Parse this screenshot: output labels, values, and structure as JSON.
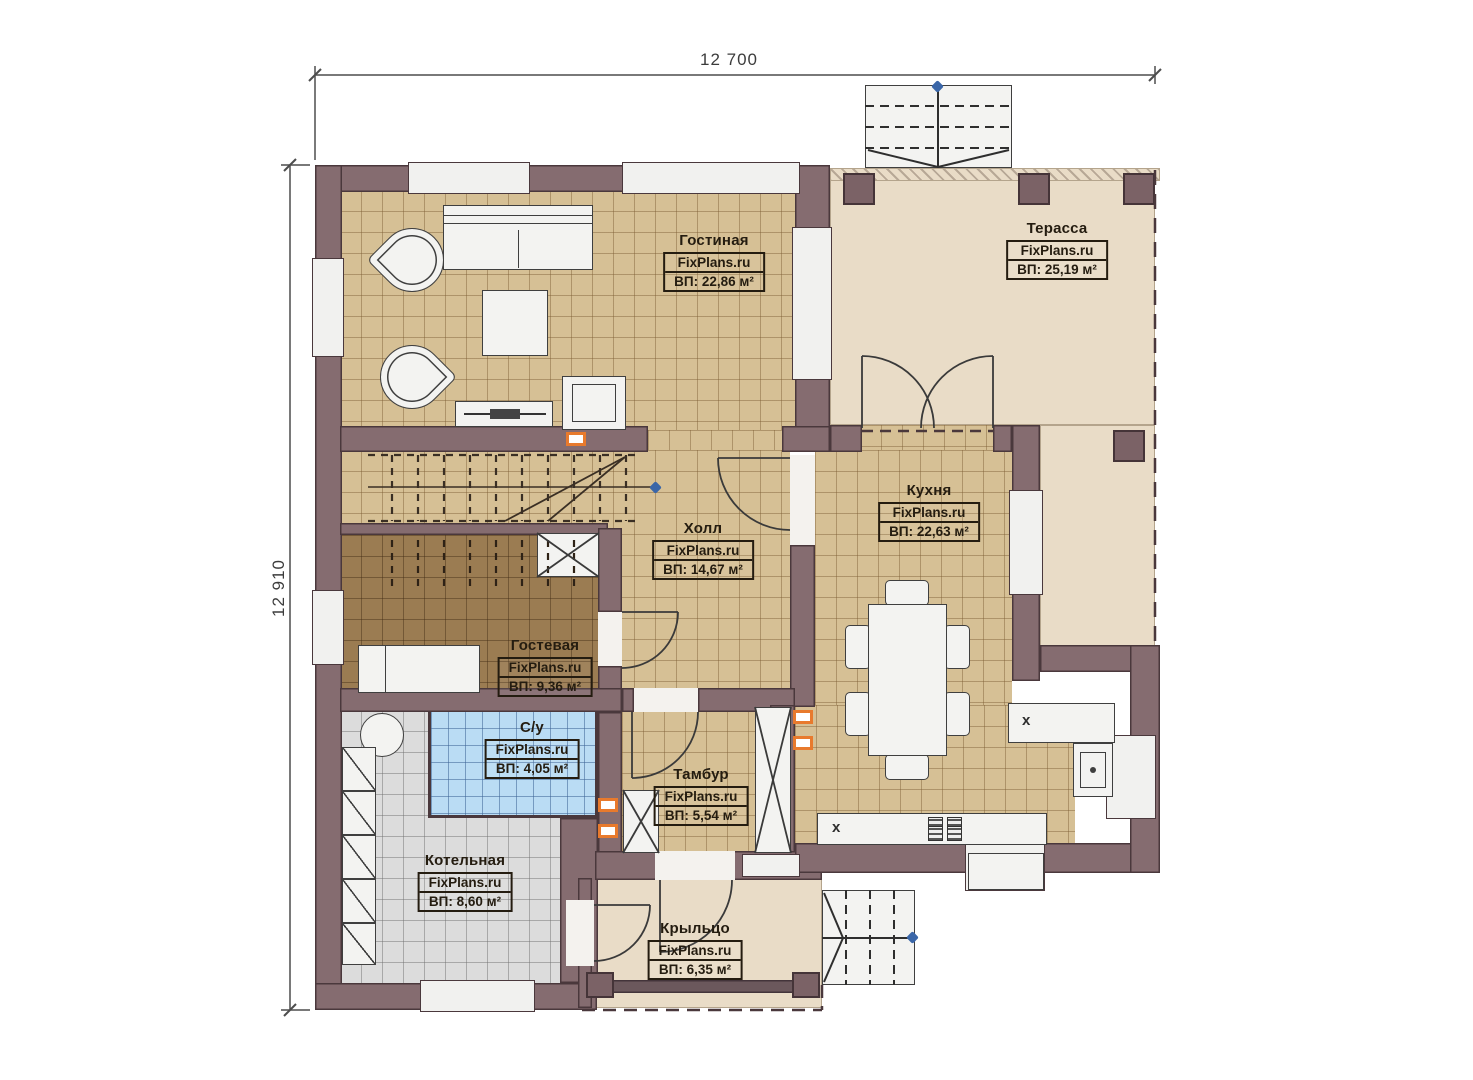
{
  "plan": {
    "watermark": "FixPlans.ru",
    "dimensions": {
      "width_mm": "12 700",
      "height_mm": "12 910"
    },
    "marks": {
      "appliance_x": "x"
    },
    "rooms": [
      {
        "name": "Гостиная",
        "area": "ВП: 22,86 м²"
      },
      {
        "name": "Терасса",
        "area": "ВП: 25,19 м²"
      },
      {
        "name": "Кухня",
        "area": "ВП: 22,63 м²"
      },
      {
        "name": "Холл",
        "area": "ВП: 14,67 м²"
      },
      {
        "name": "Гостевая",
        "area": "ВП: 9,36 м²"
      },
      {
        "name": "С/у",
        "area": "ВП: 4,05 м²"
      },
      {
        "name": "Тамбур",
        "area": "ВП: 5,54 м²"
      },
      {
        "name": "Котельная",
        "area": "ВП: 8,60 м²"
      },
      {
        "name": "Крыльцо",
        "area": "ВП: 6,35 м²"
      }
    ],
    "colors": {
      "wall": "#856c70",
      "floor_tile": "#d6c095",
      "floor_guest": "#9b7c52",
      "floor_bath": "#badcf4",
      "floor_boiler": "#dcdcdc",
      "floor_terrace": "#e9dcc7",
      "marker_orange": "#e87a2d",
      "node_blue": "#3a66a8"
    }
  }
}
